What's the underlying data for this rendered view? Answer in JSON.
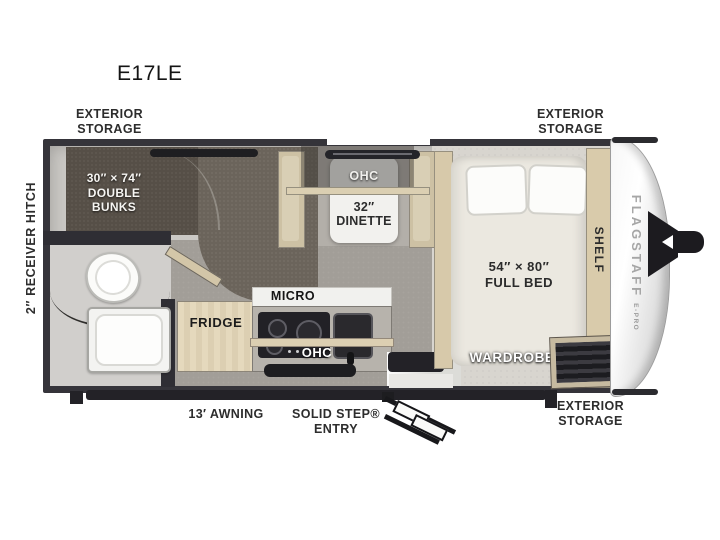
{
  "title": "E17LE",
  "colors": {
    "wall": "#35343a",
    "floor": "#cac8c4",
    "walkway": "#a29e98",
    "carpet": "#6b645b",
    "wood": "#d9cbab",
    "label_dark": "#2d2d2d",
    "label_light": "#ffffff",
    "cap_white": "#f7f7f7",
    "hitch_black": "#1c1b1f"
  },
  "labels": {
    "storage_tl": {
      "line1": "EXTERIOR",
      "line2": "STORAGE"
    },
    "storage_tr": {
      "line1": "EXTERIOR",
      "line2": "STORAGE"
    },
    "storage_br": {
      "line1": "EXTERIOR",
      "line2": "STORAGE"
    },
    "receiver_hitch": "2″ RECEIVER HITCH",
    "awning": "13′ AWNING",
    "entry": {
      "line1": "SOLID STEP®",
      "line2": "ENTRY"
    }
  },
  "rooms": {
    "bunks": {
      "line1": "30″ × 74″",
      "line2": "DOUBLE",
      "line3": "BUNKS"
    },
    "dinette": {
      "ohc": "OHC",
      "size": "32″",
      "name": "DINETTE"
    },
    "kitchen": {
      "micro": "MICRO",
      "fridge": "FRIDGE",
      "ohc": "OHC"
    },
    "bed": {
      "size": "54″ × 80″",
      "name": "FULL BED",
      "wardrobe": "WARDROBE",
      "shelf": "SHELF"
    }
  },
  "brand": {
    "name": "FLAGSTAFF",
    "series": "E-PRO"
  }
}
